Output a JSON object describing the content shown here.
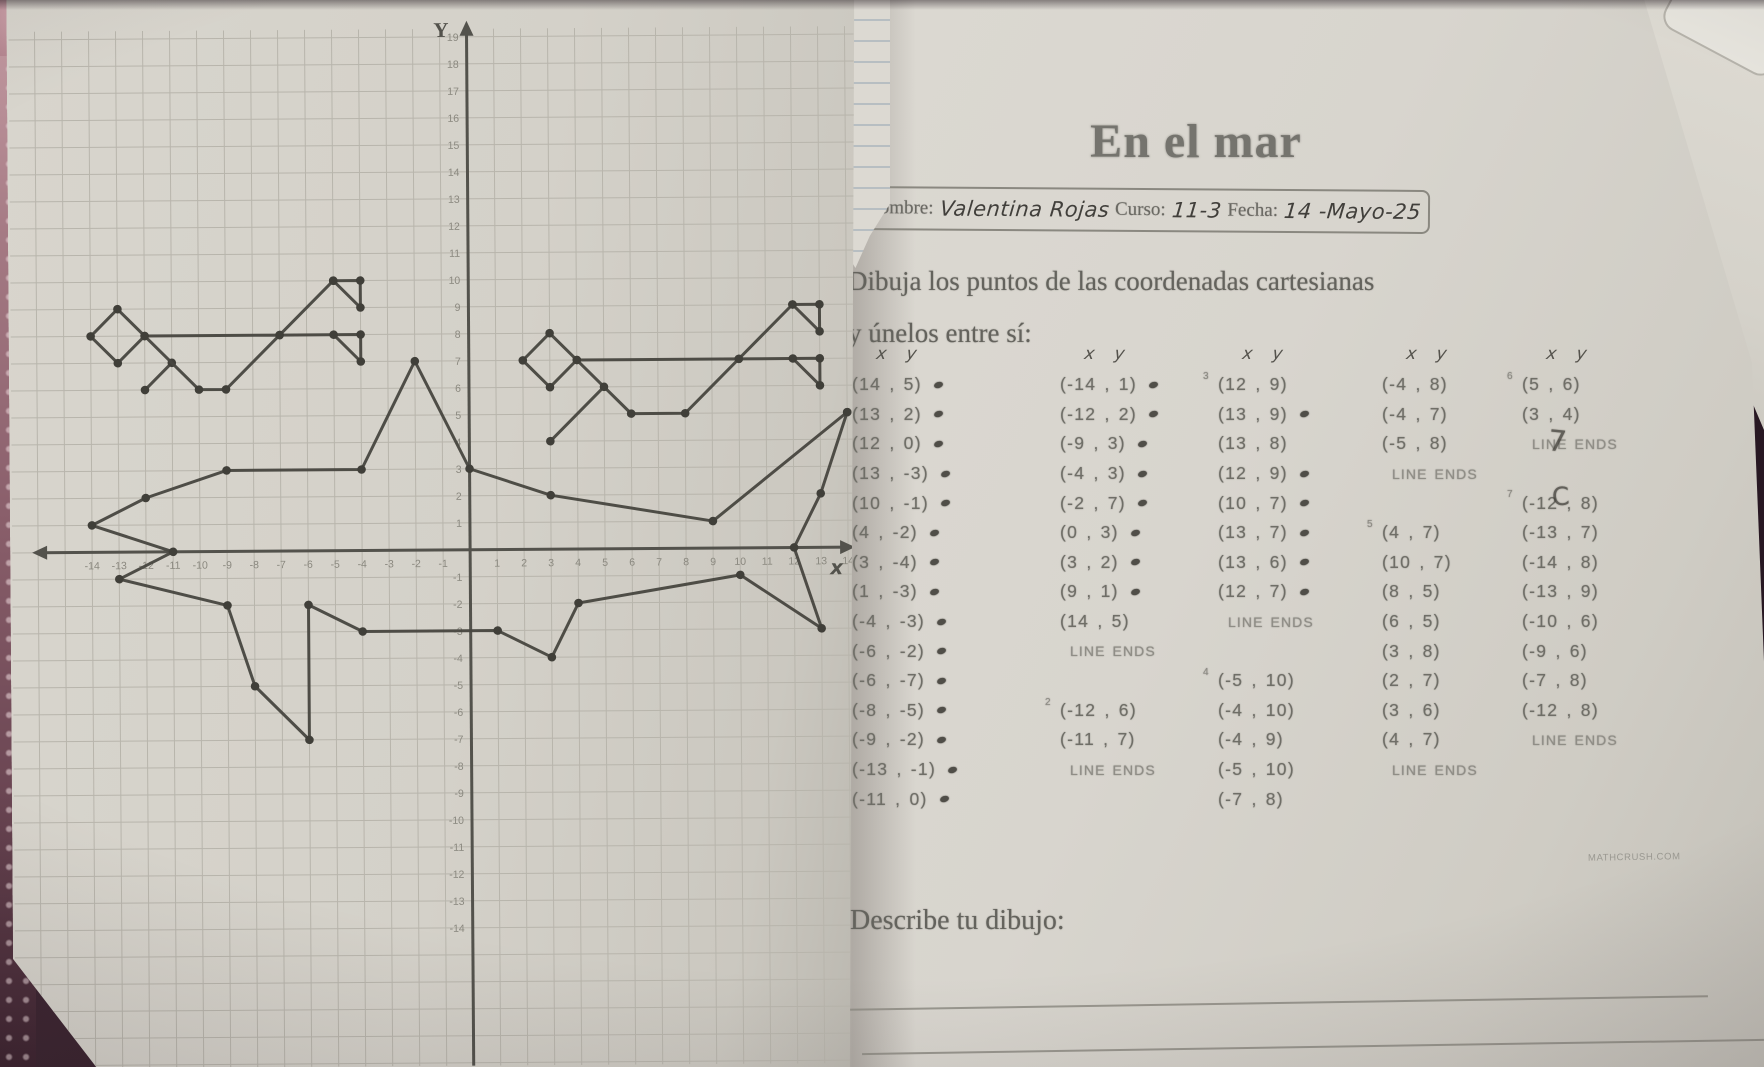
{
  "header": {
    "title": "En el mar",
    "name_label": "Nombre:",
    "name_value": "Valentina Rojas",
    "curso_label": "Curso:",
    "curso_value": "11-3",
    "fecha_label": "Fecha:",
    "fecha_value": "14 -Mayo-25"
  },
  "instructions": {
    "line1": "Dibuja los puntos de las coordenadas cartesianas",
    "line2": "y únelos entre sí:"
  },
  "col_header": {
    "x": "x",
    "y": "y"
  },
  "describe_label": "Describe tu dibujo:",
  "watermark": "MATHCRUSH.COM",
  "underlay_note": "1500, 3520",
  "stray_marks": [
    "7",
    "C"
  ],
  "coordinate_columns": [
    {
      "entries": [
        {
          "num": "1",
          "text": "(14 , 5)",
          "dot": true
        },
        {
          "text": "(13 , 2)",
          "dot": true
        },
        {
          "text": "(12 , 0)",
          "dot": true
        },
        {
          "text": "(13 , -3)",
          "dot": true
        },
        {
          "text": "(10 , -1)",
          "dot": true
        },
        {
          "text": "(4 , -2)",
          "dot": true
        },
        {
          "text": "(3 , -4)",
          "dot": true
        },
        {
          "text": "(1 , -3)",
          "dot": true
        },
        {
          "text": "(-4 , -3)",
          "dot": true
        },
        {
          "text": "(-6 , -2)",
          "dot": true
        },
        {
          "text": "(-6 , -7)",
          "dot": true
        },
        {
          "text": "(-8 , -5)",
          "dot": true
        },
        {
          "text": "(-9 , -2)",
          "dot": true
        },
        {
          "text": "(-13 , -1)",
          "dot": true
        },
        {
          "text": "(-11 , 0)",
          "dot": true
        }
      ]
    },
    {
      "entries": [
        {
          "text": "(-14 , 1)",
          "dot": true
        },
        {
          "text": "(-12 , 2)",
          "dot": true
        },
        {
          "text": "(-9 , 3)",
          "dot": true
        },
        {
          "text": "(-4 , 3)",
          "dot": true
        },
        {
          "text": "(-2 , 7)",
          "dot": true
        },
        {
          "text": "(0 , 3)",
          "dot": true
        },
        {
          "text": "(3 , 2)",
          "dot": true
        },
        {
          "text": "(9 , 1)",
          "dot": true
        },
        {
          "text": "(14 , 5)"
        },
        {
          "line_end": true,
          "text": "LINE ENDS"
        },
        {
          "gap": true
        },
        {
          "num": "2",
          "text": "(-12 , 6)"
        },
        {
          "text": "(-11 , 7)"
        },
        {
          "line_end": true,
          "text": "LINE ENDS"
        }
      ]
    },
    {
      "entries": [
        {
          "num": "3",
          "text": "(12 , 9)"
        },
        {
          "text": "(13 , 9)",
          "dot": true
        },
        {
          "text": "(13 , 8)"
        },
        {
          "text": "(12 , 9)",
          "dot": true
        },
        {
          "text": "(10 , 7)",
          "dot": true
        },
        {
          "text": "(13 , 7)",
          "dot": true
        },
        {
          "text": "(13 , 6)",
          "dot": true
        },
        {
          "text": "(12 , 7)",
          "dot": true
        },
        {
          "line_end": true,
          "text": "LINE ENDS"
        },
        {
          "gap": true
        },
        {
          "num": "4",
          "text": "(-5 , 10)"
        },
        {
          "text": "(-4 , 10)"
        },
        {
          "text": "(-4 , 9)"
        },
        {
          "text": "(-5 , 10)"
        },
        {
          "text": "(-7 , 8)"
        }
      ]
    },
    {
      "entries": [
        {
          "text": "(-4 , 8)"
        },
        {
          "text": "(-4 , 7)"
        },
        {
          "text": "(-5 , 8)"
        },
        {
          "line_end": true,
          "text": "LINE ENDS"
        },
        {
          "gap": true
        },
        {
          "num": "5",
          "text": "(4 , 7)"
        },
        {
          "text": "(10 , 7)"
        },
        {
          "text": "(8 , 5)"
        },
        {
          "text": "(6 , 5)"
        },
        {
          "text": "(3 , 8)"
        },
        {
          "text": "(2 , 7)"
        },
        {
          "text": "(3 , 6)"
        },
        {
          "text": "(4 , 7)"
        },
        {
          "line_end": true,
          "text": "LINE ENDS"
        }
      ]
    },
    {
      "entries": [
        {
          "num": "6",
          "text": "(5 , 6)"
        },
        {
          "text": "(3 , 4)"
        },
        {
          "line_end": true,
          "text": "LINE ENDS"
        },
        {
          "gap": true
        },
        {
          "num": "7",
          "text": "(-12 , 8)"
        },
        {
          "text": "(-13 , 7)"
        },
        {
          "text": "(-14 , 8)"
        },
        {
          "text": "(-13 , 9)"
        },
        {
          "text": "(-10 , 6)"
        },
        {
          "text": "(-9 , 6)"
        },
        {
          "text": "(-7 , 8)"
        },
        {
          "text": "(-12 , 8)"
        },
        {
          "line_end": true,
          "text": "LINE ENDS"
        }
      ]
    }
  ],
  "chart_data": {
    "type": "line",
    "title": "En el mar — connect-the-coordinates drawing (shark)",
    "xlabel": "x",
    "ylabel": "Y",
    "xlim": [
      -16,
      14.3
    ],
    "ylim": [
      -19,
      19.8
    ],
    "x_tick_min": -14,
    "x_tick_max": 14,
    "y_tick_min": -14,
    "y_tick_max": 19,
    "grid": true,
    "series": [
      {
        "name": "group-1-body",
        "points": [
          [
            14,
            5
          ],
          [
            13,
            2
          ],
          [
            12,
            0
          ],
          [
            13,
            -3
          ],
          [
            10,
            -1
          ],
          [
            4,
            -2
          ],
          [
            3,
            -4
          ],
          [
            1,
            -3
          ],
          [
            -4,
            -3
          ],
          [
            -6,
            -2
          ],
          [
            -6,
            -7
          ],
          [
            -8,
            -5
          ],
          [
            -9,
            -2
          ],
          [
            -13,
            -1
          ],
          [
            -11,
            0
          ],
          [
            -14,
            1
          ],
          [
            -12,
            2
          ],
          [
            -9,
            3
          ],
          [
            -4,
            3
          ],
          [
            -2,
            7
          ],
          [
            0,
            3
          ],
          [
            3,
            2
          ],
          [
            9,
            1
          ],
          [
            14,
            5
          ]
        ]
      },
      {
        "name": "group-2",
        "points": [
          [
            -12,
            6
          ],
          [
            -11,
            7
          ]
        ]
      },
      {
        "name": "group-3",
        "points": [
          [
            12,
            9
          ],
          [
            13,
            9
          ],
          [
            13,
            8
          ],
          [
            12,
            9
          ],
          [
            10,
            7
          ],
          [
            13,
            7
          ],
          [
            13,
            6
          ],
          [
            12,
            7
          ]
        ]
      },
      {
        "name": "group-4",
        "points": [
          [
            -5,
            10
          ],
          [
            -4,
            10
          ],
          [
            -4,
            9
          ],
          [
            -5,
            10
          ],
          [
            -7,
            8
          ],
          [
            -4,
            8
          ],
          [
            -4,
            7
          ],
          [
            -5,
            8
          ]
        ]
      },
      {
        "name": "group-5",
        "points": [
          [
            4,
            7
          ],
          [
            10,
            7
          ],
          [
            8,
            5
          ],
          [
            6,
            5
          ],
          [
            3,
            8
          ],
          [
            2,
            7
          ],
          [
            3,
            6
          ],
          [
            4,
            7
          ]
        ]
      },
      {
        "name": "group-6",
        "points": [
          [
            5,
            6
          ],
          [
            3,
            4
          ]
        ]
      },
      {
        "name": "group-7",
        "points": [
          [
            -12,
            8
          ],
          [
            -13,
            7
          ],
          [
            -14,
            8
          ],
          [
            -13,
            9
          ],
          [
            -10,
            6
          ],
          [
            -9,
            6
          ],
          [
            -7,
            8
          ],
          [
            -12,
            8
          ]
        ]
      }
    ]
  }
}
